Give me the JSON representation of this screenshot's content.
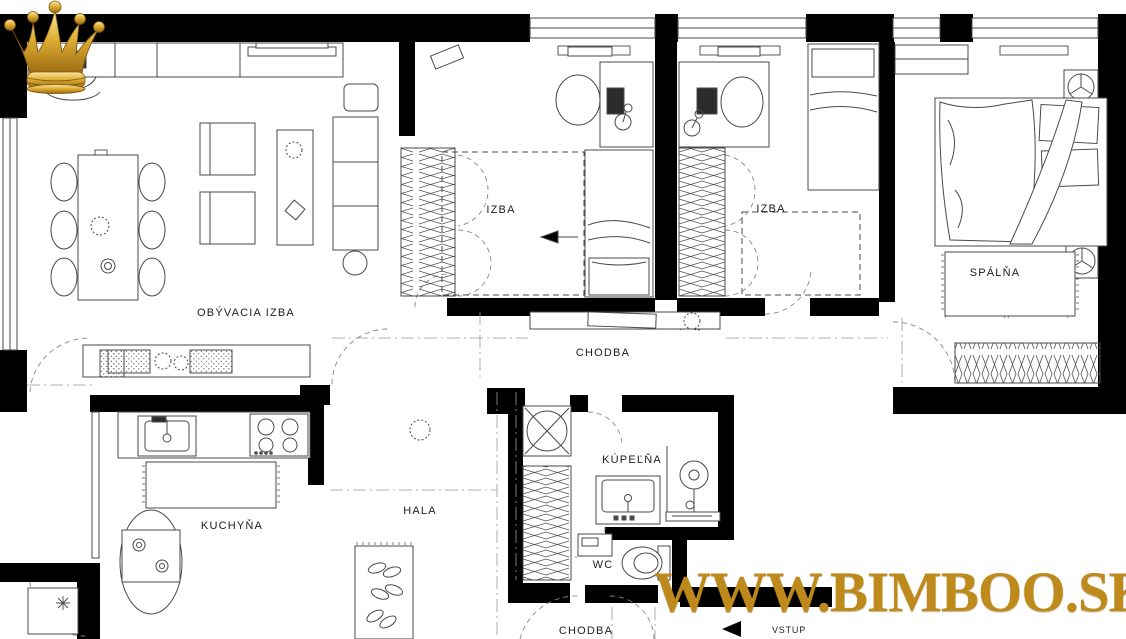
{
  "rooms": [
    {
      "id": "obyvacia-izba",
      "label": "OBÝVACIA IZBA"
    },
    {
      "id": "izba-1",
      "label": "IZBA"
    },
    {
      "id": "izba-2",
      "label": "IZBA"
    },
    {
      "id": "spalna",
      "label": "SPÁLŇA"
    },
    {
      "id": "chodba-horna",
      "label": "CHODBA"
    },
    {
      "id": "kuchyna",
      "label": "KUCHYŇA"
    },
    {
      "id": "hala",
      "label": "HALA"
    },
    {
      "id": "kupelna",
      "label": "KÚPEĽŇA"
    },
    {
      "id": "wc",
      "label": "WC"
    },
    {
      "id": "chodba-dolna",
      "label": "CHODBA"
    },
    {
      "id": "vstup",
      "label": "VSTUP"
    }
  ],
  "watermark": {
    "site": "WWW.BIMBOO.SK",
    "gold": "#BD8A1B"
  },
  "colors": {
    "walls": "#000000",
    "furniture_lines": "#4a4a4a",
    "reference_lines": "#999999"
  }
}
